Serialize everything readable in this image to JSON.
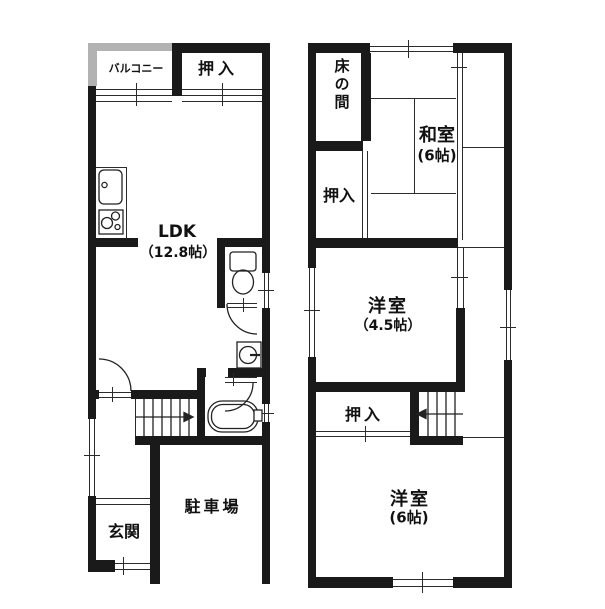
{
  "figure": {
    "type": "floor-plan",
    "floors": 2,
    "units": "帖"
  },
  "floor1": {
    "balcony": "バルコニー",
    "closet": "押入",
    "ldk_name": "LDK",
    "ldk_size": "（12.8帖）",
    "entrance": "玄関",
    "parking": "駐車場"
  },
  "floor2": {
    "tokonoma": "床の間",
    "japanese_room": "和室",
    "japanese_room_size": "(6帖)",
    "closet_upper": "押入",
    "western_room_small": "洋室",
    "western_room_small_size": "（4.5帖）",
    "closet_lower": "押入",
    "western_room_large": "洋室",
    "western_room_large_size": "(6帖)"
  },
  "colors": {
    "wall": "#1a1a1a",
    "balcony_wall": "#b2b2b2",
    "thin_line": "#2b2b2b",
    "background": "#ffffff",
    "text": "#111111"
  }
}
